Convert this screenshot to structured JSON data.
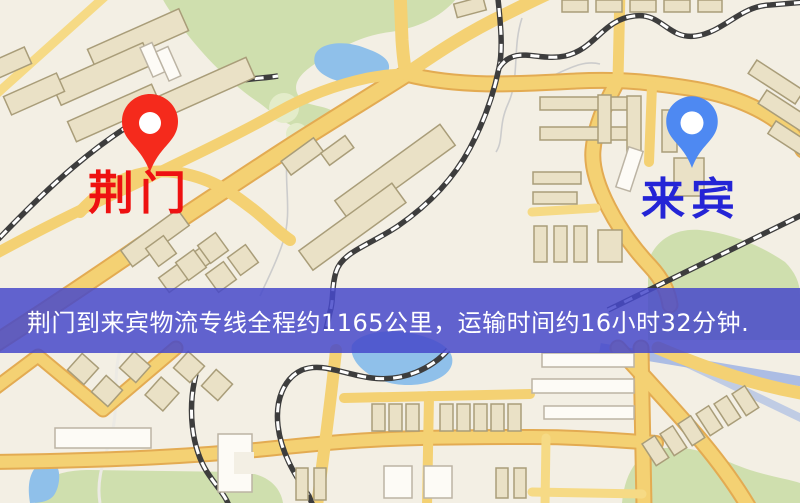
{
  "banner": {
    "text": "荆门到来宾物流专线全程约1165公里，运输时间约16小时32分钟.",
    "background_color": "#4649ca",
    "text_color": "#ffffff"
  },
  "map": {
    "origin": {
      "name": "荆门",
      "label_color": "#ee1111",
      "pin_color": "#f52a1c"
    },
    "destination": {
      "name": "来宾",
      "label_color": "#2424d6",
      "pin_color": "#4e89f2"
    },
    "palette": {
      "land": "#f3efe4",
      "road": "#f4d173",
      "road_casing": "#e3ab52",
      "park": "#cfdfae",
      "water": "#8fc0ea",
      "building": "#eae1c6",
      "building_outline": "#a99d79",
      "railway": "#3d3d3d"
    }
  }
}
